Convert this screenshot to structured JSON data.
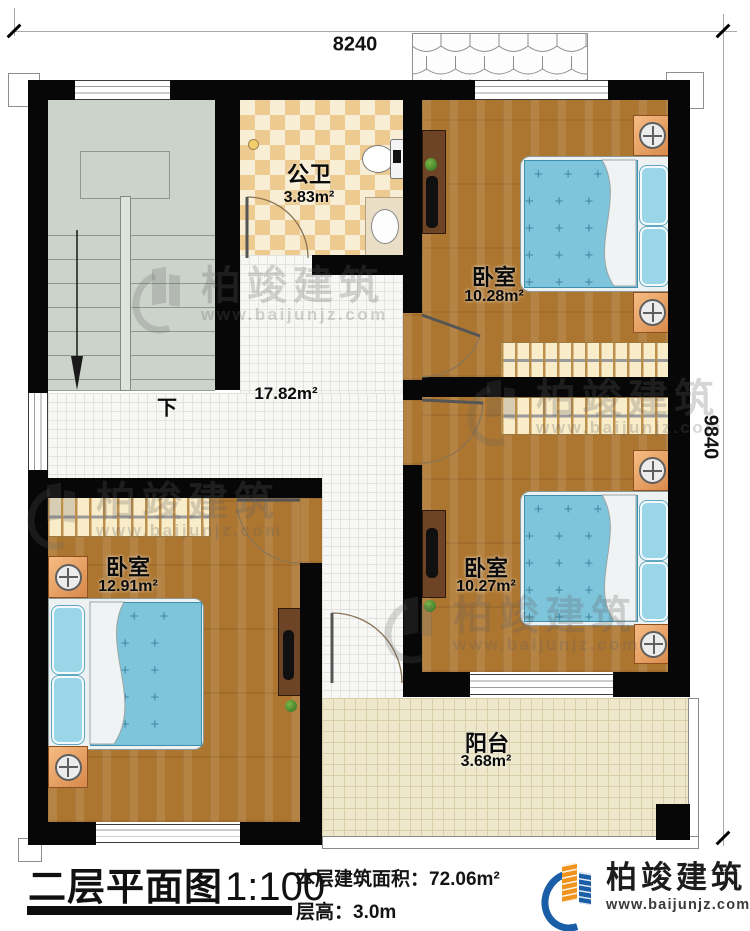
{
  "dimensions": {
    "top": "8240",
    "right": "9840"
  },
  "rooms": {
    "bathroom": {
      "name": "公卫",
      "area": "3.83m²"
    },
    "bedroom_top_right": {
      "name": "卧室",
      "area": "10.28m²"
    },
    "bedroom_mid_right": {
      "name": "卧室",
      "area": "10.27m²"
    },
    "bedroom_bottom_left": {
      "name": "卧室",
      "area": "12.91m²"
    },
    "hallway": {
      "area": "17.82m²"
    },
    "balcony": {
      "name": "阳台",
      "area": "3.68m²"
    },
    "stairs": {
      "down_label": "下"
    }
  },
  "title_block": {
    "title": "二层平面图",
    "scale": "1:100",
    "area_label": "本层建筑面积：",
    "area_value": "72.06m²",
    "height_label": "层高：",
    "height_value": "3.0m"
  },
  "branding": {
    "company": "柏竣建筑",
    "website": "www.baijunjz.com"
  },
  "watermark": {
    "company": "柏竣建筑",
    "website": "www.baijunjz.com"
  },
  "colors": {
    "wall": "#070707",
    "wood": "#ad7630",
    "mattress": "#7ec4da",
    "logo_blue": "#1b5ea8",
    "logo_orange": "#f0941e"
  }
}
